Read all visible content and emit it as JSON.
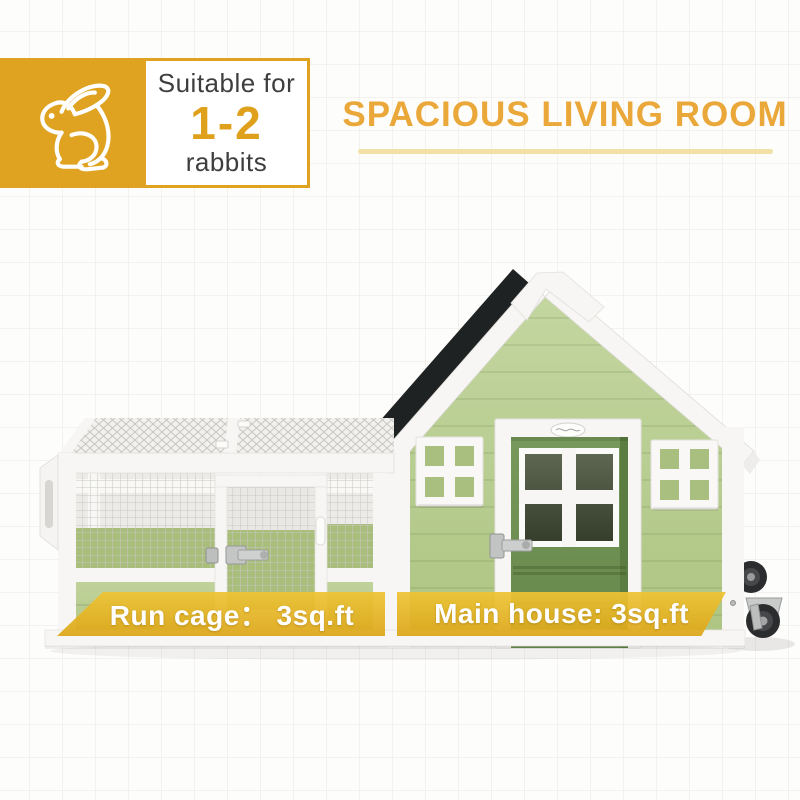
{
  "suitability_badge": {
    "icon": "rabbit-icon",
    "prefix": "Suitable for",
    "count": "1-2",
    "suffix": "rabbits"
  },
  "headline": "SPACIOUS LIVING ROOM",
  "banners": {
    "run_cage": "Run cage： 3sq.ft",
    "main_house": "Main house: 3sq.ft"
  },
  "colors": {
    "accent_gold": "#DFA321",
    "count_gold": "#DFA11C",
    "headline_gold": "#EBA83A",
    "underline_gold": "#F3E0A6",
    "text_dark": "#3E3E3E",
    "wall_green": "#B6CB8F",
    "door_green": "#6F9254",
    "door_green_dark": "#5B7D41",
    "pane_green": "#A9BF7F",
    "floor_green": "#A8BE7A",
    "panel_green": "#BBCF94",
    "roof_black": "#1F2223",
    "frame_white": "#F7F6F4"
  }
}
